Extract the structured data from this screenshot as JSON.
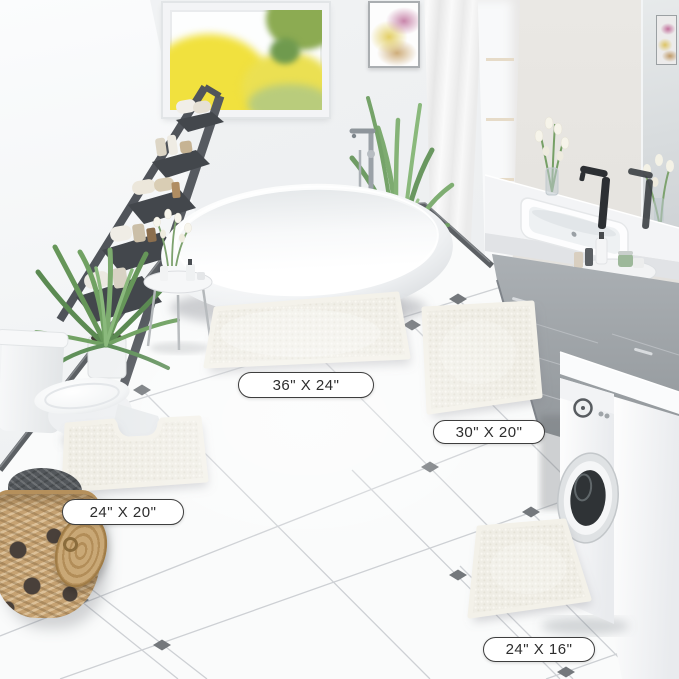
{
  "scene": {
    "description": "Bright modern bathroom product photo showcasing a four-piece white chenille bath rug set"
  },
  "rugs": [
    {
      "name": "rectangular-bath-rug-large",
      "size_label": "36\" X 24\""
    },
    {
      "name": "rectangular-bath-rug-medium",
      "size_label": "30\" X 20\""
    },
    {
      "name": "contour-toilet-rug",
      "size_label": "24\" X 20\""
    },
    {
      "name": "rectangular-bath-rug-small",
      "size_label": "24\" X 16\""
    }
  ],
  "palette": {
    "rug": "#efede5",
    "floor": "#fafbfb",
    "diamond_accent": "#74787c",
    "wall": "#eef0f2",
    "vanity_gray": "#a7acb0",
    "label_border": "#3e3e3e",
    "label_text": "#2d2d2d"
  }
}
